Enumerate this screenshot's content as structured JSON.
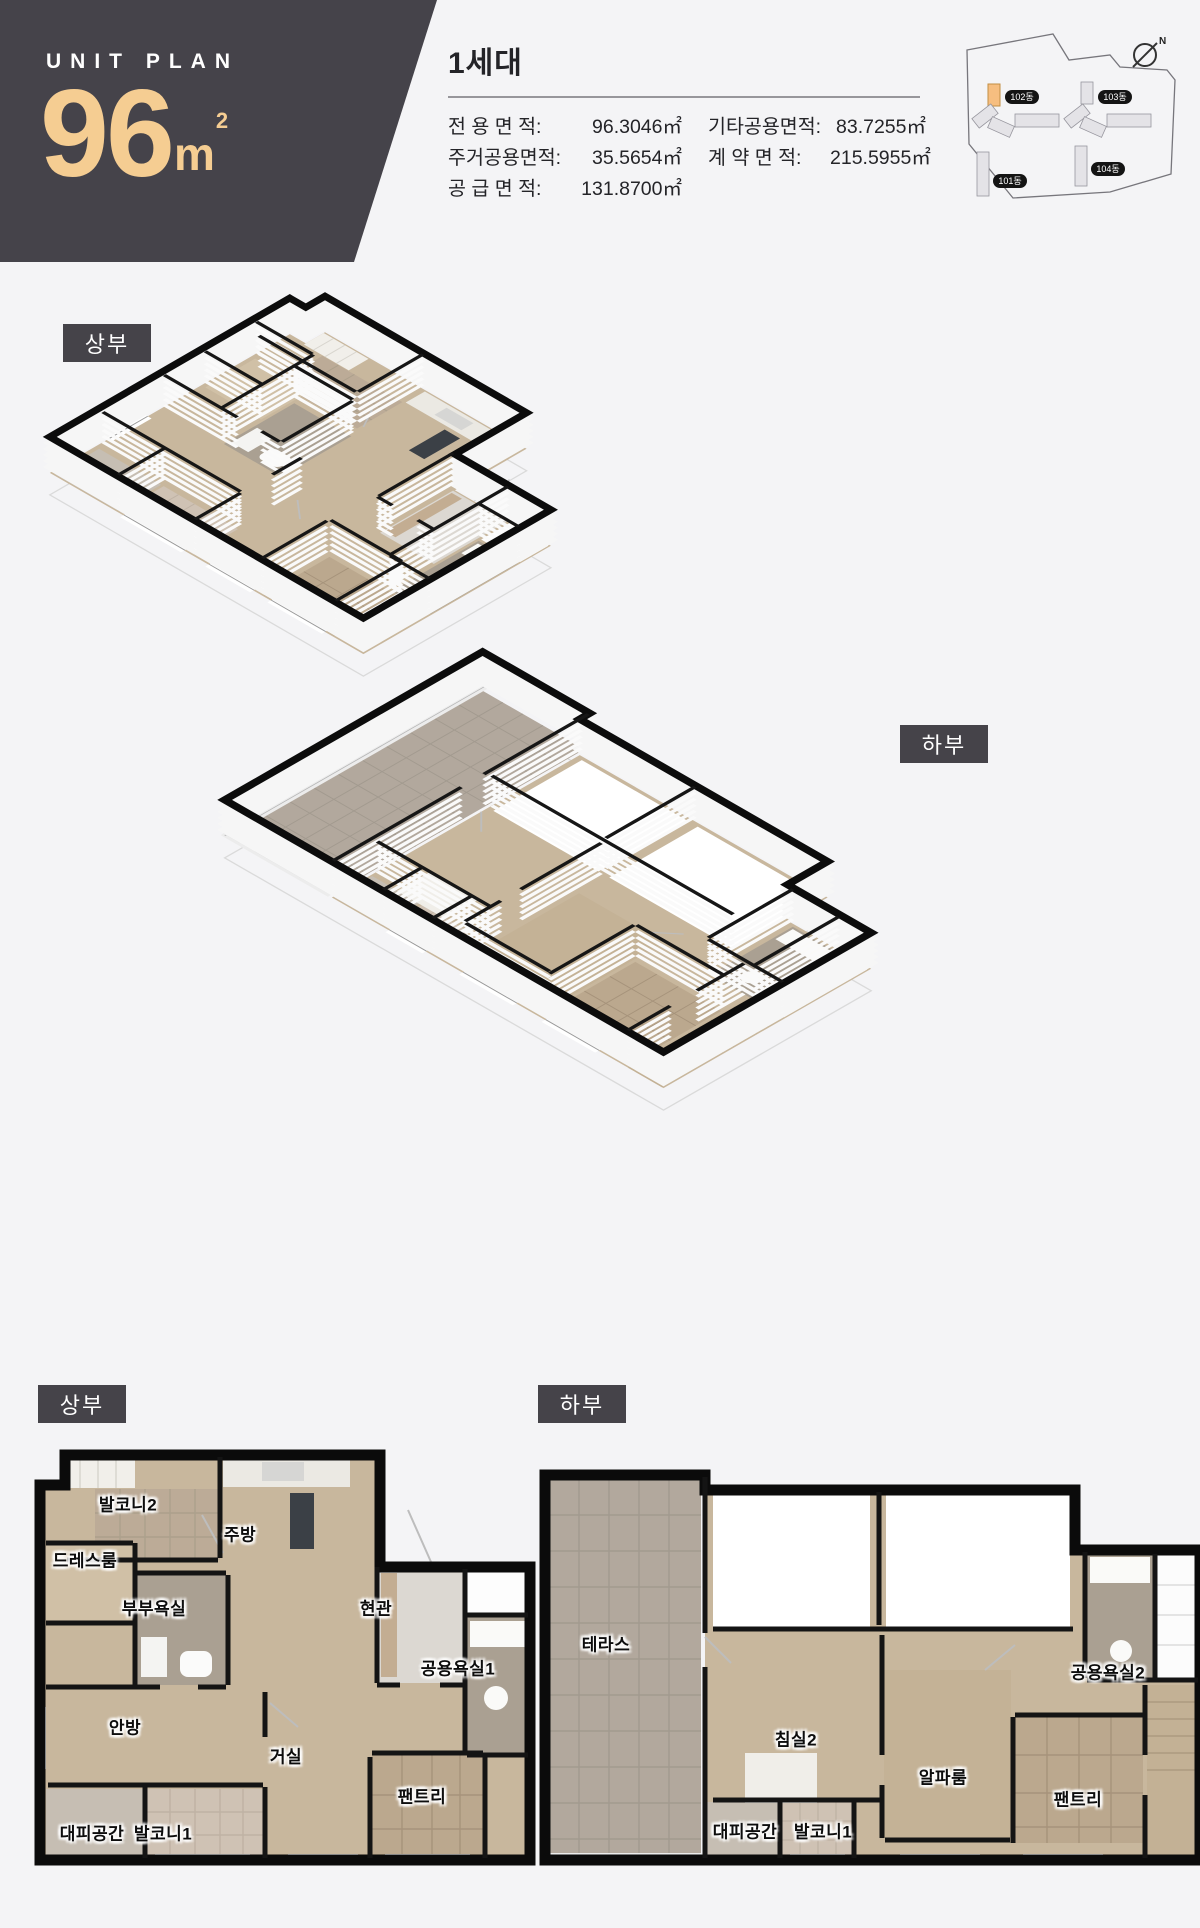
{
  "colors": {
    "page_bg": "#F4F4F6",
    "header_bg": "#45434A",
    "accent": "#F5CD92",
    "label_bg": "#454349",
    "wall": "#0C0C0C",
    "wood_floor": "#C8B79D",
    "tile_floor": "#B2A89D",
    "highlight_building": "#F6BE80"
  },
  "header": {
    "title": "UNIT PLAN",
    "size_number": "96",
    "size_unit": "m",
    "size_unit_sup": "2"
  },
  "unit_info": {
    "title": "1세대",
    "areas": [
      {
        "label": "전 용 면 적",
        "value": "96.3046㎡"
      },
      {
        "label": "기타공용면적",
        "value": "83.7255㎡"
      },
      {
        "label": "주거공용면적",
        "value": "35.5654㎡"
      },
      {
        "label": "계 약 면 적",
        "value": "215.5955㎡"
      },
      {
        "label": "공 급 면 적",
        "value": "131.8700㎡"
      }
    ]
  },
  "site_map": {
    "compass_label": "N",
    "highlighted_building": "102동",
    "buildings": [
      {
        "name": "102동"
      },
      {
        "name": "103동"
      },
      {
        "name": "101동"
      },
      {
        "name": "104동"
      }
    ]
  },
  "iso_views": {
    "upper_label": "상부",
    "lower_label": "하부"
  },
  "floor_plans": {
    "upper": {
      "label": "상부",
      "rooms": [
        {
          "name": "발코니2"
        },
        {
          "name": "드레스룸"
        },
        {
          "name": "주방"
        },
        {
          "name": "부부욕실"
        },
        {
          "name": "현관"
        },
        {
          "name": "공용욕실1"
        },
        {
          "name": "안방"
        },
        {
          "name": "거실"
        },
        {
          "name": "팬트리"
        },
        {
          "name": "대피공간"
        },
        {
          "name": "발코니1"
        }
      ]
    },
    "lower": {
      "label": "하부",
      "rooms": [
        {
          "name": "테라스"
        },
        {
          "name": "공용욕실2"
        },
        {
          "name": "침실2"
        },
        {
          "name": "알파룸"
        },
        {
          "name": "팬트리"
        },
        {
          "name": "대피공간"
        },
        {
          "name": "발코니1"
        }
      ]
    }
  }
}
